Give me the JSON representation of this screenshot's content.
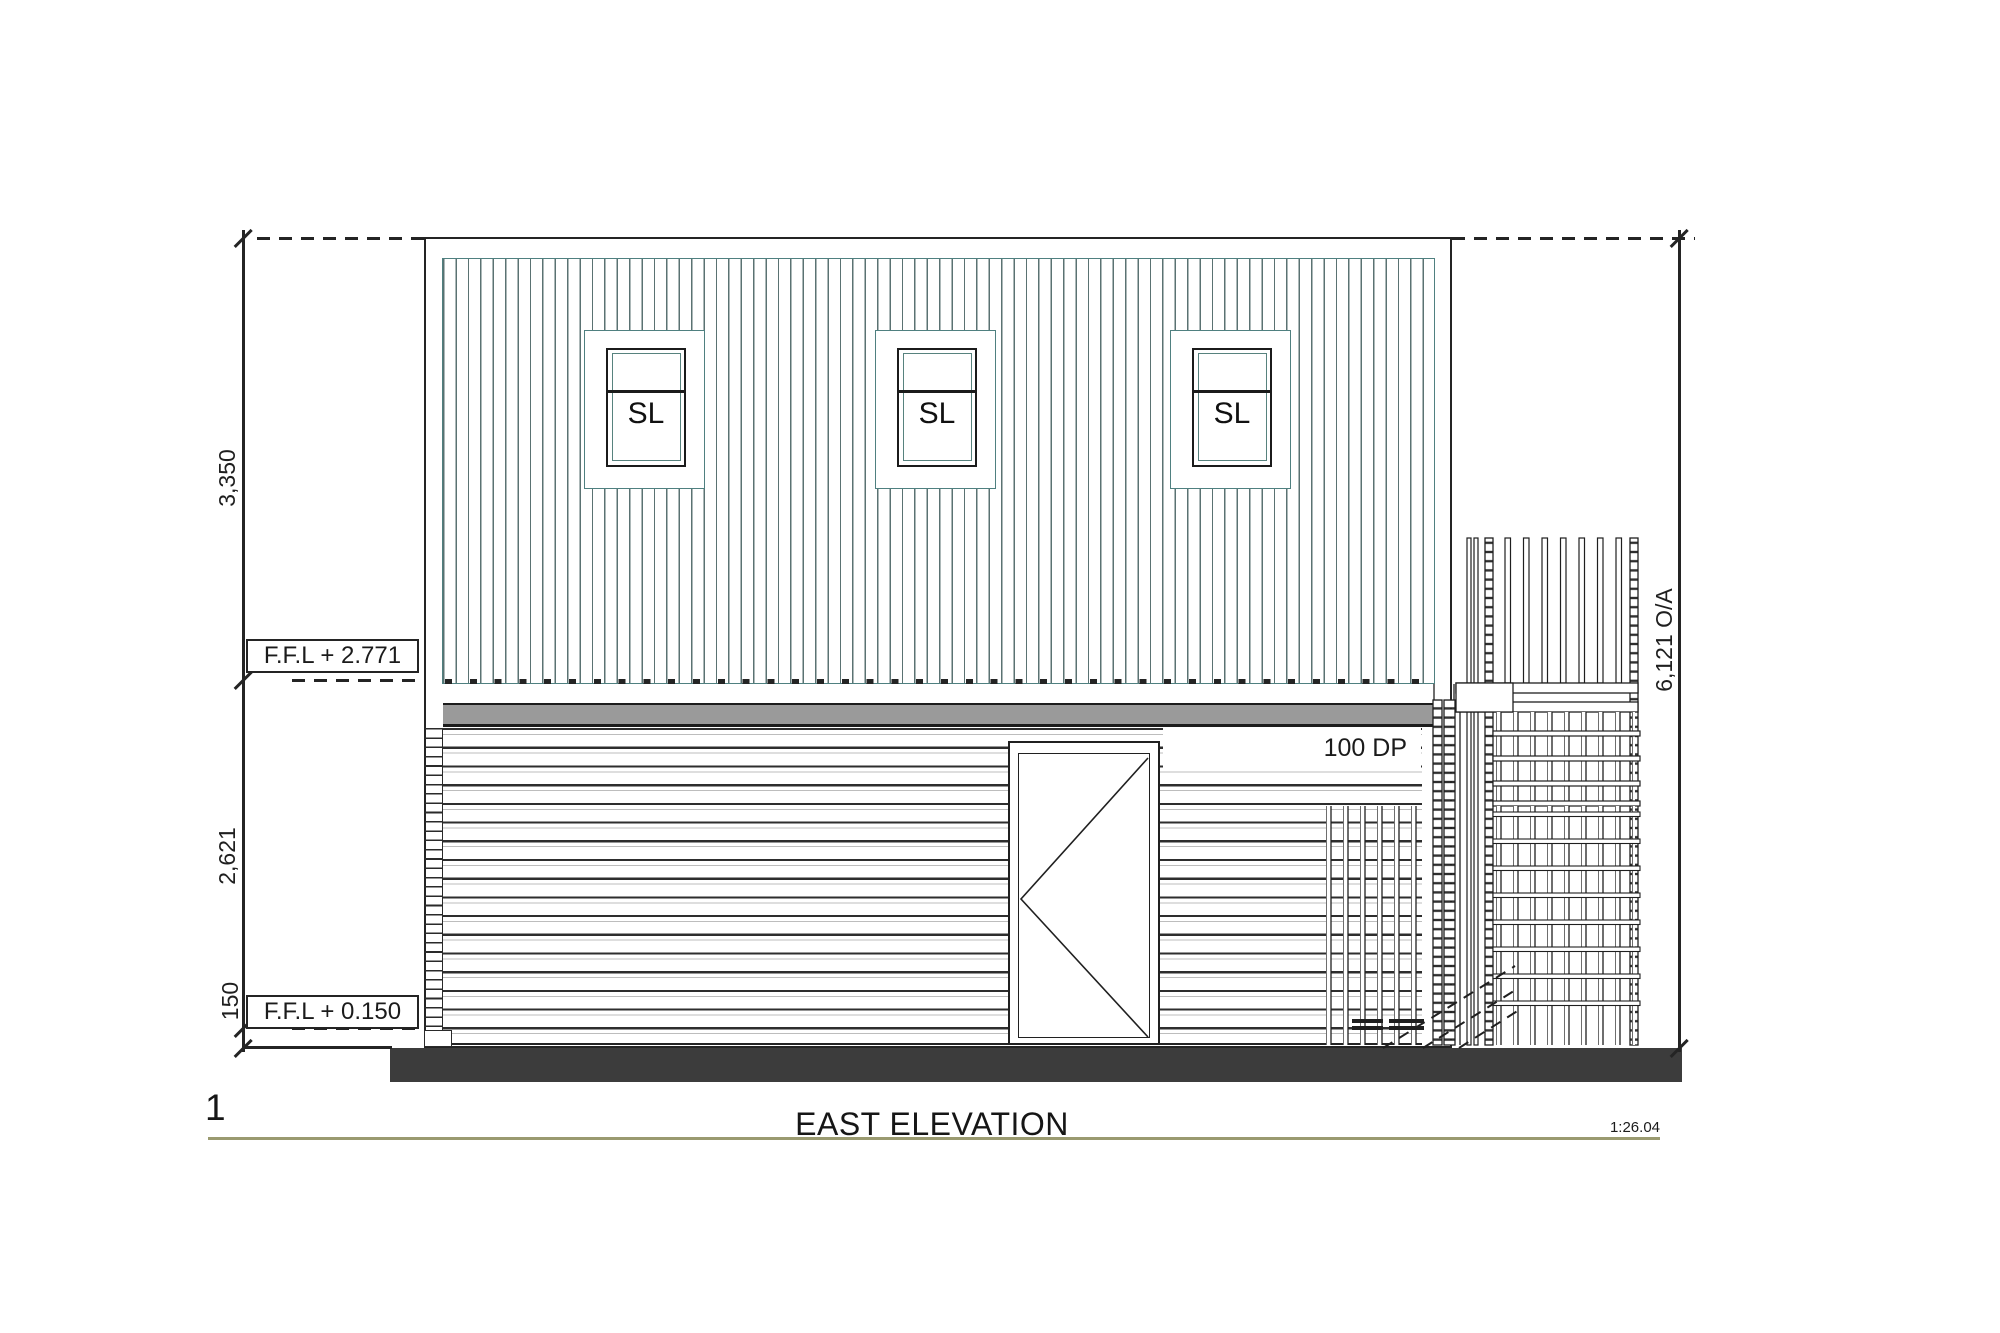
{
  "drawing": {
    "number": "1",
    "title": "EAST ELEVATION",
    "scale": "1:26.04"
  },
  "levels": {
    "upper_ffl": "F.F.L + 2.771",
    "ground_ffl": "F.F.L + 0.150"
  },
  "dimensions": {
    "upper_storey": "3,350",
    "lower_storey": "2,621",
    "plinth": "150",
    "overall": "6,121 O/A"
  },
  "annotations": {
    "downpipe": "100 DP"
  },
  "windows": [
    {
      "label": "SL"
    },
    {
      "label": "SL"
    },
    {
      "label": "SL"
    }
  ],
  "colors": {
    "cladding_line": "#5a7272",
    "cladding_border": "#4f8080",
    "eaves_band_gray": "#9a9a9a",
    "slab_dark": "#3c3c3c",
    "line_dark": "#242424",
    "title_rule_olive": "#9a9a70"
  }
}
